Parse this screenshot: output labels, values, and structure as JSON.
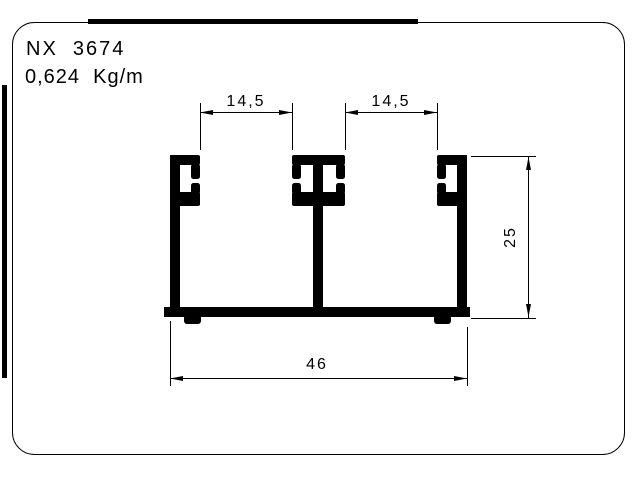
{
  "page": {
    "background_color": "#ffffff",
    "ink_color": "#000000"
  },
  "title_block": {
    "code": "NX  3674",
    "weight": "0,624  Kg/m"
  },
  "drawing": {
    "type": "aluminum-extrusion-profile-cross-section",
    "dimensions": {
      "groove_left": "14,5",
      "groove_right": "14,5",
      "height": "25",
      "width": "46"
    }
  }
}
